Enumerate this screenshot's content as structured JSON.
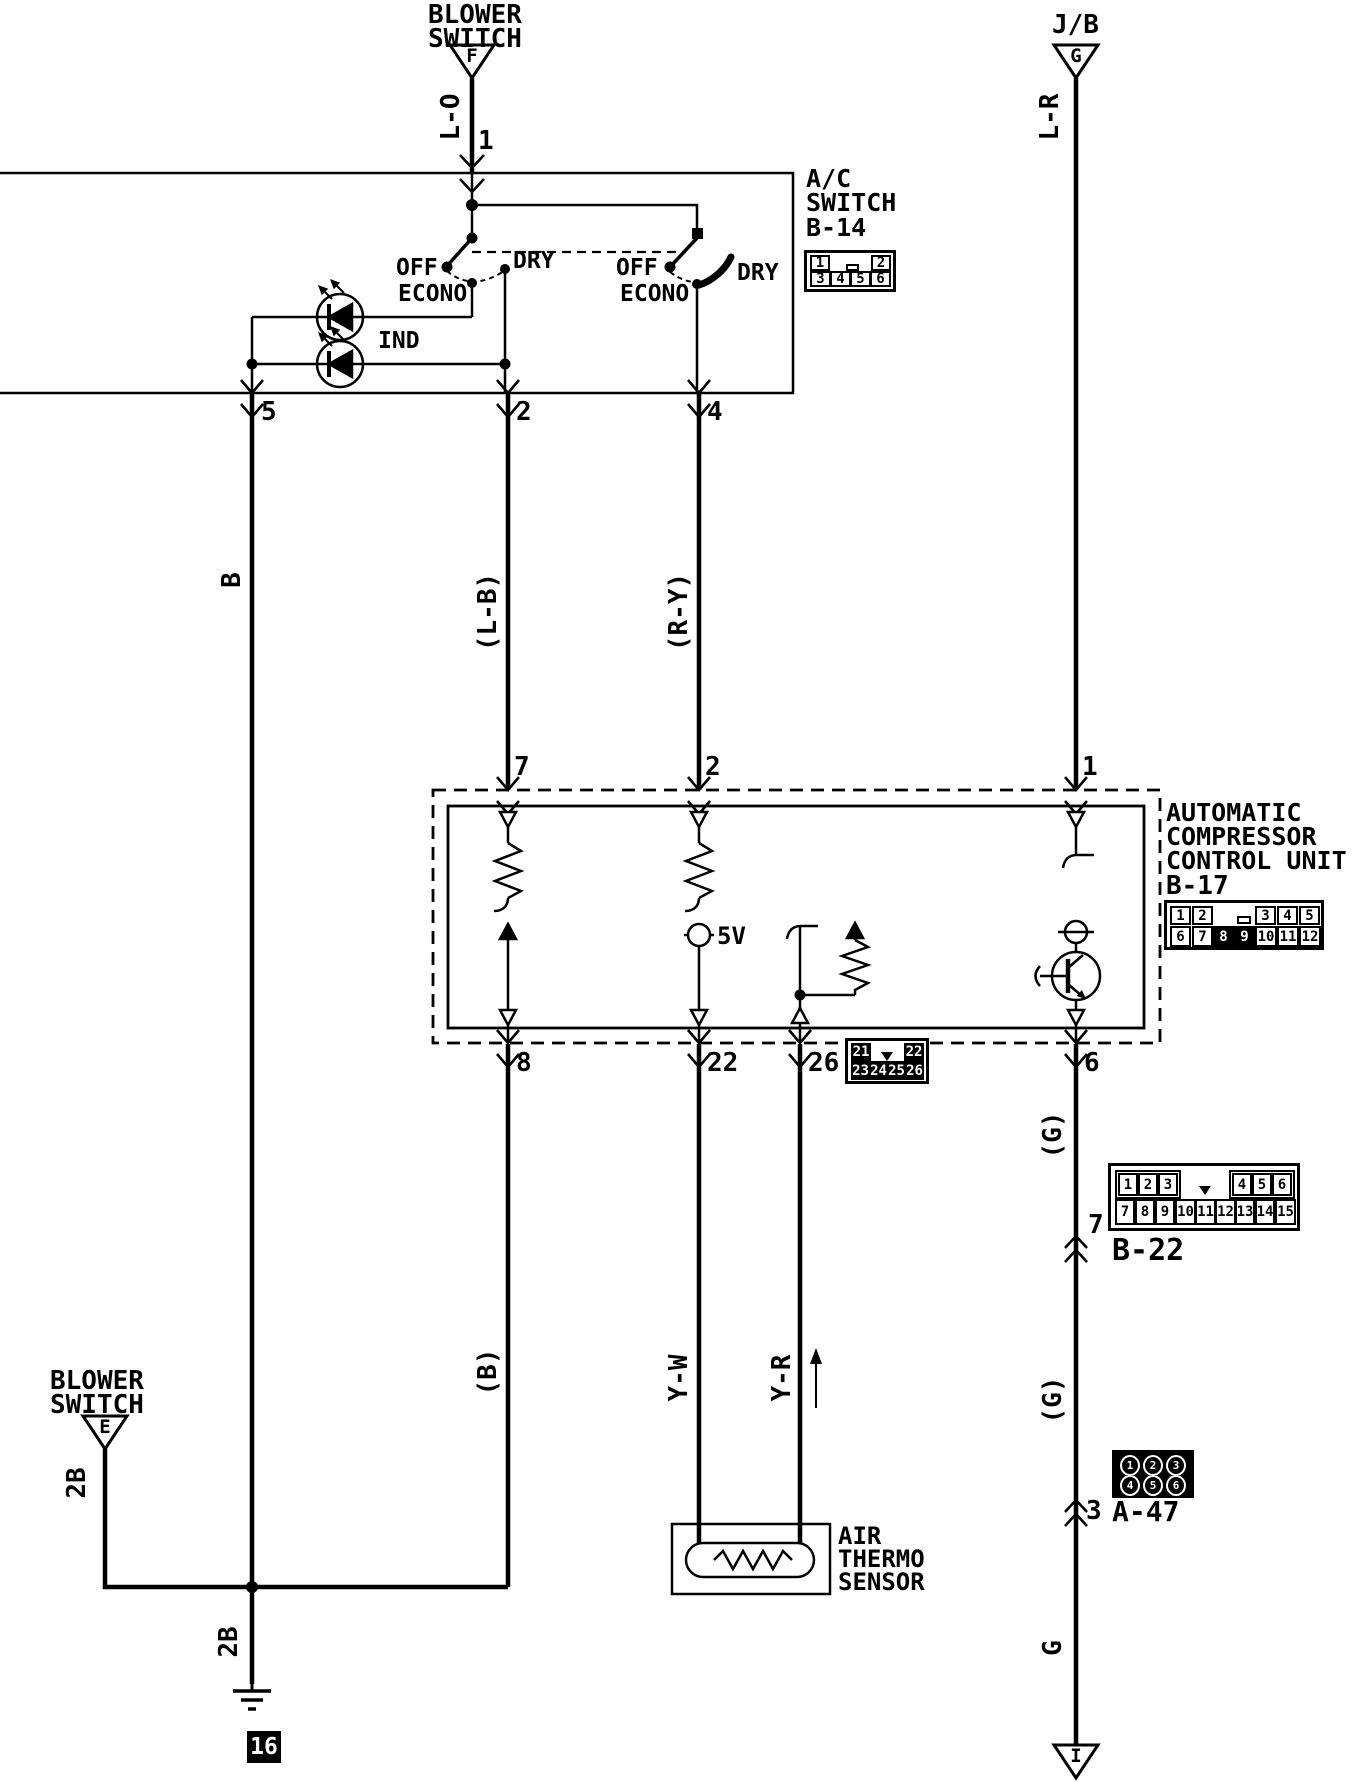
{
  "colors": {
    "ink": "#000000",
    "paper": "#ffffff"
  },
  "labels": {
    "blower_f1": "BLOWER",
    "blower_f2": "SWITCH",
    "ref_f": "F",
    "jb": "J/B",
    "ref_g": "G",
    "wire_lo": "L-O",
    "wire_lr": "L-R",
    "pin1": "1",
    "ac1": "A/C",
    "ac2": "SWITCH",
    "ac3": "B-14",
    "off1": "OFF",
    "dry1": "DRY",
    "econo1": "ECONO",
    "off2": "OFF",
    "dry2": "DRY",
    "econo2": "ECONO",
    "ind": "IND",
    "pin5": "5",
    "pin2": "2",
    "pin4": "4",
    "wire_b": "B",
    "wire_lb": "(L-B)",
    "wire_ry": "(R-Y)",
    "cu_pin7": "7",
    "cu_pin2": "2",
    "cu_pin1": "1",
    "cu1": "AUTOMATIC",
    "cu2": "COMPRESSOR",
    "cu3": "CONTROL UNIT",
    "cu4": "B-17",
    "v5": "5V",
    "cu_pin8": "8",
    "cu_pin22": "22",
    "cu_pin26": "26",
    "cu_pin6": "6",
    "wire_b_low": "(B)",
    "wire_g1": "(G)",
    "wire_g2": "(G)",
    "wire_g3": "G",
    "b22_pin": "7",
    "b22": "B-22",
    "a47_pin": "3",
    "a47": "A-47",
    "wire_yw": "Y-W",
    "wire_yr": "Y-R",
    "air1": "AIR",
    "air2": "THERMO",
    "air3": "SENSOR",
    "blower_e1": "BLOWER",
    "blower_e2": "SWITCH",
    "ref_e": "E",
    "wire_2b_1": "2B",
    "wire_2b_2": "2B",
    "ground_id": "16",
    "ref_i": "I"
  },
  "connectors": {
    "b14": {
      "top": [
        "1",
        "2"
      ],
      "bottom": [
        "3",
        "4",
        "5",
        "6"
      ]
    },
    "b17": {
      "top": [
        "1",
        "2",
        "3",
        "4",
        "5"
      ],
      "bottom": [
        "6",
        "7",
        "8",
        "9",
        "10",
        "11",
        "12"
      ]
    },
    "b17sub": {
      "top": [
        "21",
        "22"
      ],
      "bottom": [
        "23",
        "24",
        "25",
        "26"
      ]
    },
    "b22": {
      "top": [
        "1",
        "2",
        "3",
        "4",
        "5",
        "6"
      ],
      "bottom": [
        "7",
        "8",
        "9",
        "10",
        "11",
        "12",
        "13",
        "14",
        "15"
      ]
    },
    "a47": {
      "top": [
        "1",
        "2",
        "3"
      ],
      "bottom": [
        "4",
        "5",
        "6"
      ]
    }
  }
}
